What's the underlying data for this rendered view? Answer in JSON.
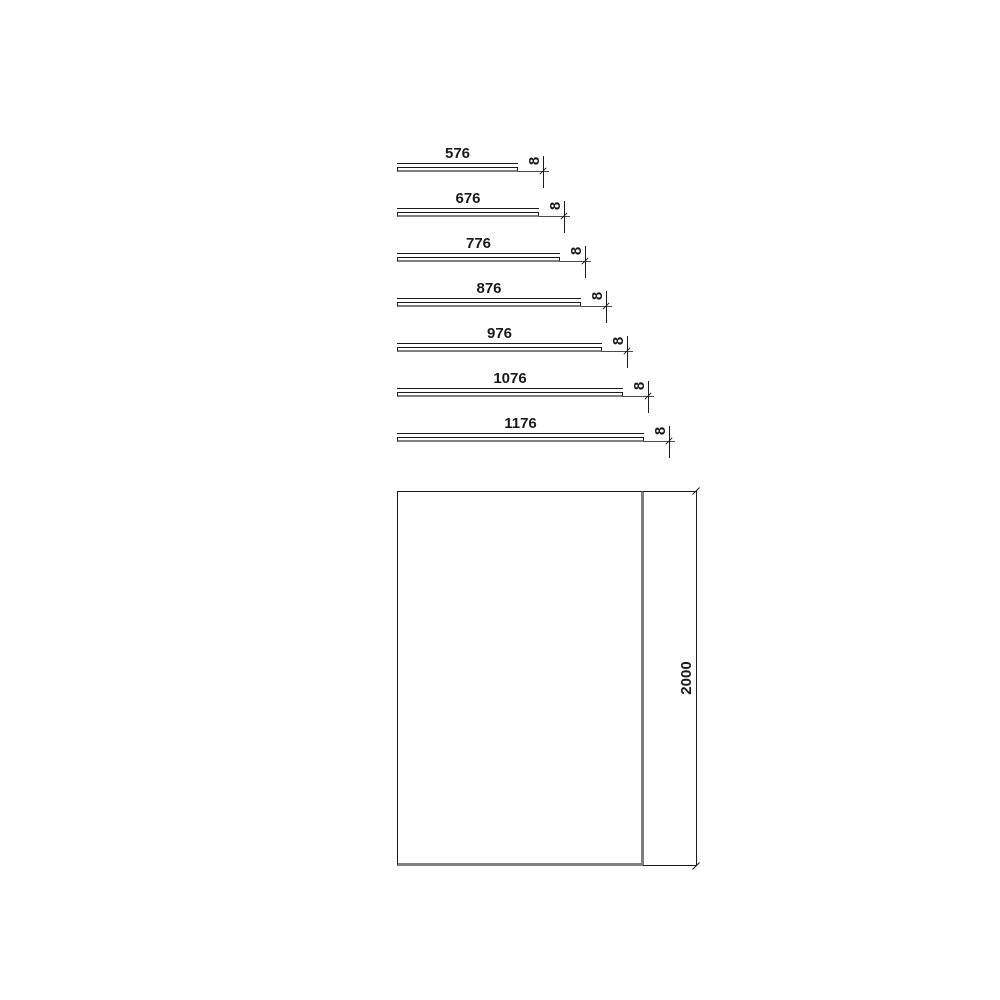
{
  "diagram": {
    "title": "panel-dimension-diagram",
    "profile_views": {
      "panels": [
        {
          "width_label": "576",
          "width_mm": 576
        },
        {
          "width_label": "676",
          "width_mm": 676
        },
        {
          "width_label": "776",
          "width_mm": 776
        },
        {
          "width_label": "876",
          "width_mm": 876
        },
        {
          "width_label": "976",
          "width_mm": 976
        },
        {
          "width_label": "1076",
          "width_mm": 1076
        },
        {
          "width_label": "1176",
          "width_mm": 1176
        }
      ],
      "thickness_label": "8",
      "thickness_mm": 8
    },
    "front_view": {
      "height_label": "2000",
      "height_mm": 2000
    },
    "colors": {
      "line": "#1a1a1a",
      "panel_shadow": "#7f7f7f",
      "background": "#ffffff"
    }
  }
}
